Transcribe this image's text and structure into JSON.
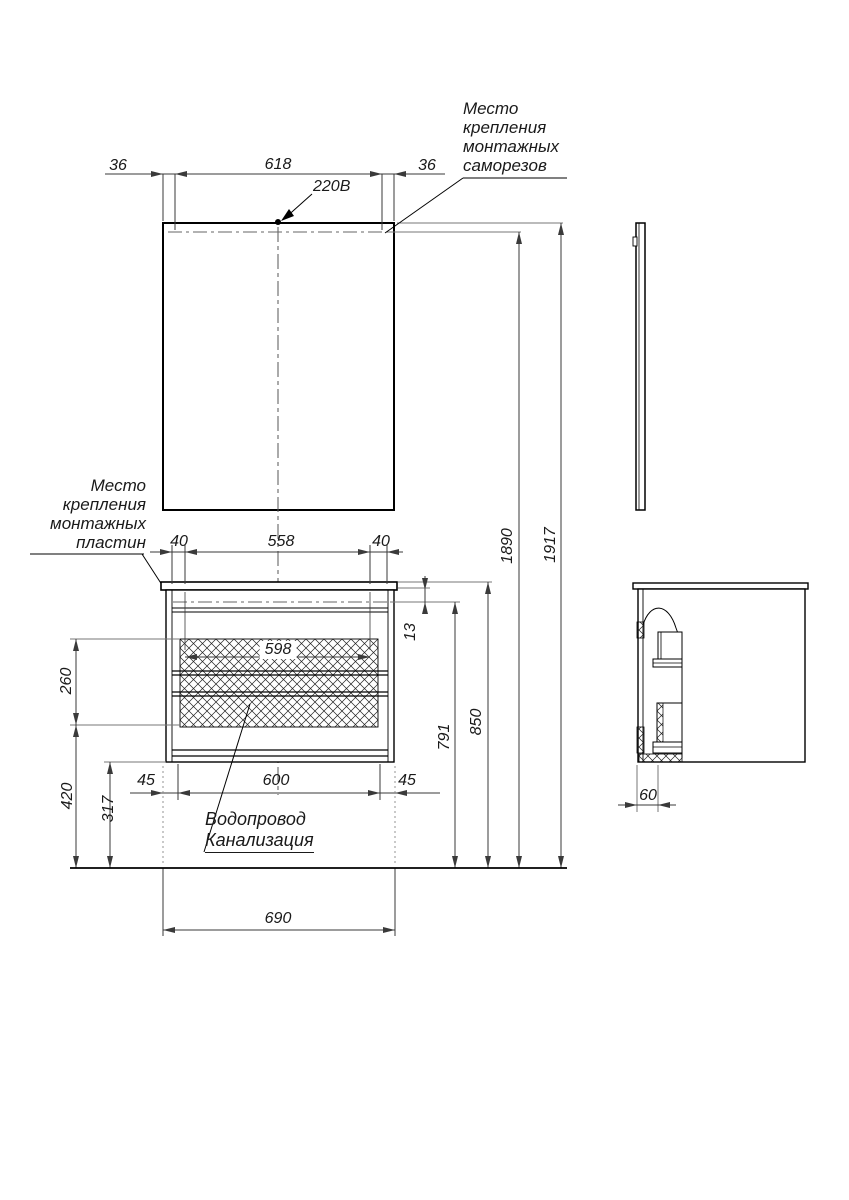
{
  "drawing": {
    "voltage_label": "220В",
    "top_dims": {
      "left_margin": "36",
      "screw_span": "618",
      "right_margin": "36"
    },
    "plate_dims": {
      "left": "40",
      "span": "558",
      "right": "40"
    },
    "hatch_dims": {
      "width": "598",
      "height": "260"
    },
    "gap_dim": "13",
    "base_dims": {
      "left": "45",
      "body_width": "600",
      "right": "45"
    },
    "height_dims": {
      "cabinet": "791",
      "countertop": "850",
      "screw_level": "1890",
      "mirror_top": "1917"
    },
    "floor_dims": {
      "service_zone": "420",
      "clearance": "317"
    },
    "total_width": "690",
    "side_depth": "60",
    "notes": {
      "screws": [
        "Место",
        "крепления",
        "монтажных",
        "саморезов"
      ],
      "plates": [
        "Место",
        "крепления",
        "монтажных",
        "пластин"
      ],
      "plumbing": [
        "Водопровод",
        "Канализация"
      ]
    }
  }
}
